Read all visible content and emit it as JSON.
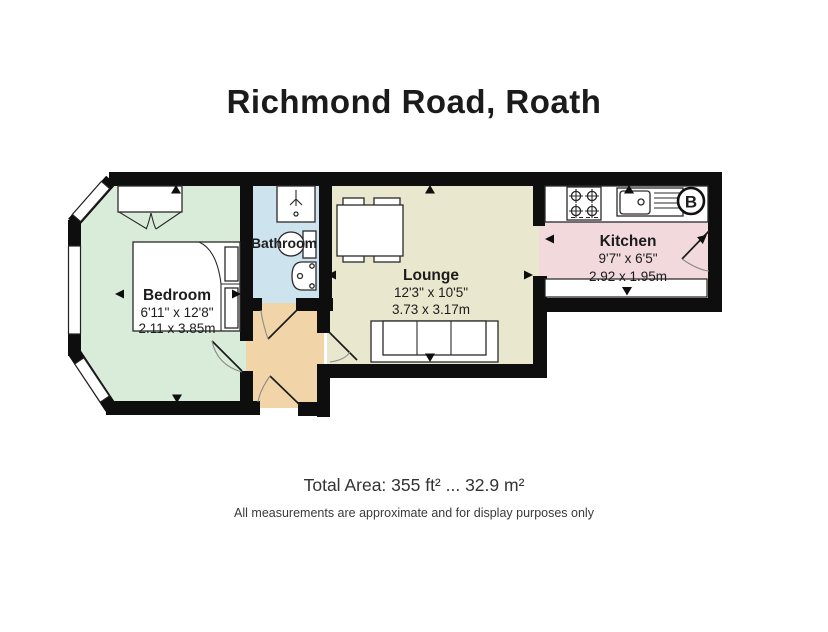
{
  "title": "Richmond Road, Roath",
  "rooms": {
    "bedroom": {
      "name": "Bedroom",
      "imperial": "6'11\" x 12'8\"",
      "metric": "2.11 x 3.85m",
      "color": "#d9ecd9"
    },
    "bathroom": {
      "name": "Bathroom",
      "color": "#cde4ee"
    },
    "lounge": {
      "name": "Lounge",
      "imperial": "12'3\" x 10'5\"",
      "metric": "3.73 x 3.17m",
      "color": "#e9e7cd"
    },
    "kitchen": {
      "name": "Kitchen",
      "imperial": "9'7\" x 6'5\"",
      "metric": "2.92 x 1.95m",
      "color": "#f1d9dc"
    },
    "hallway": {
      "color": "#f1d5a9"
    }
  },
  "symbols": {
    "boiler_label": "B"
  },
  "colors": {
    "wall": "#0e0e0e",
    "background": "#ffffff"
  },
  "footer": {
    "total_area": "Total Area: 355 ft² ... 32.9 m²",
    "disclaimer": "All measurements are approximate and for display purposes only"
  }
}
